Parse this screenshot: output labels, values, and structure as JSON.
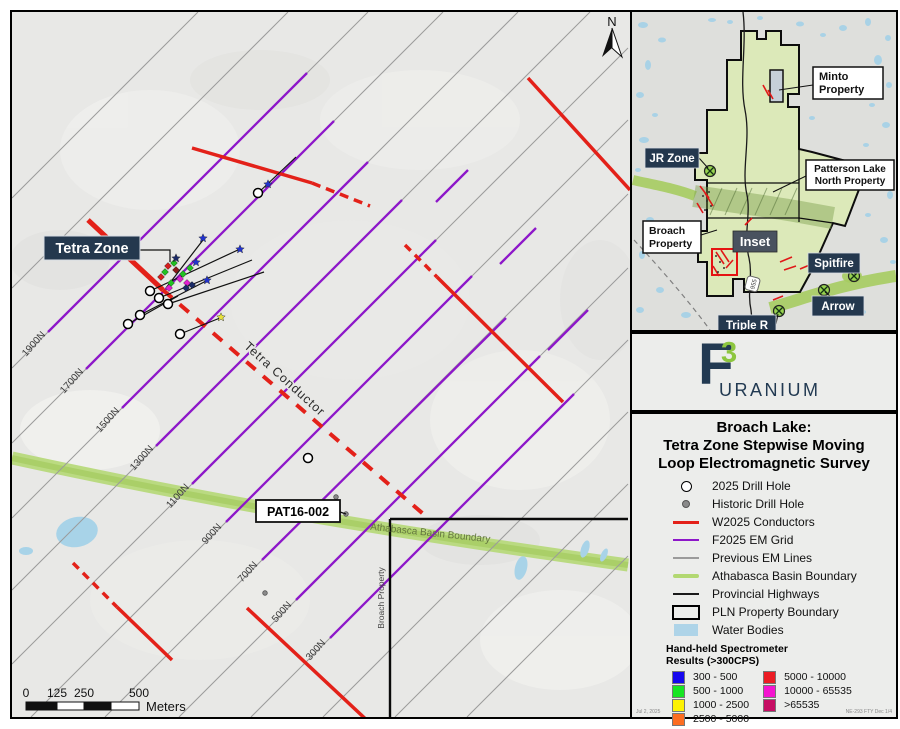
{
  "colors": {
    "conductor_red": "#e32119",
    "em_grid_purple": "#8d17c9",
    "previous_em_gray": "#9b9b9b",
    "basin_green": "#b2d871",
    "water_blue": "#aed4e8",
    "label_navy": "#24384e",
    "logo_navy": "#223a52",
    "logo_green": "#8dc63f"
  },
  "main_map": {
    "tetra_zone_label": "Tetra Zone",
    "tetra_conductor_label": "Tetra Conductor",
    "pat16_label": "PAT16-002",
    "athabasca_label": "Athabasca Basin Boundary",
    "broach_property_label": "Broach Property",
    "north_label": "N",
    "line_labels": [
      "1900N",
      "1700N",
      "1500N",
      "1300N",
      "1100N",
      "900N",
      "700N",
      "500N",
      "300N"
    ],
    "scale_ticks": [
      "0",
      "125",
      "250",
      "500"
    ],
    "scale_unit": "Meters"
  },
  "inset": {
    "minto_line1": "Minto",
    "minto_line2": "Property",
    "jr_zone": "JR Zone",
    "pln_line1": "Patterson Lake",
    "pln_line2": "North Property",
    "broach_line1": "Broach",
    "broach_line2": "Property",
    "inset_label": "Inset",
    "spitfire": "Spitfire",
    "arrow": "Arrow",
    "triple_r": "Triple R",
    "highway_955": "955"
  },
  "logo": {
    "f": "F",
    "three": "3",
    "name": "URANIUM"
  },
  "legend": {
    "title_line1": "Broach Lake:",
    "title_line2": "Tetra Zone Stepwise Moving",
    "title_line3": "Loop Electromagnetic Survey",
    "items": [
      {
        "label": "2025 Drill Hole",
        "swatch": "open-circle"
      },
      {
        "label": "Historic Drill Hole",
        "swatch": "gray-dot"
      },
      {
        "label": "W2025 Conductors",
        "swatch": "red-line",
        "color": "#e32119"
      },
      {
        "label": "F2025 EM Grid",
        "swatch": "purple-line",
        "color": "#8d17c9"
      },
      {
        "label": "Previous EM Lines",
        "swatch": "gray-line",
        "color": "#9b9b9b"
      },
      {
        "label": "Athabasca Basin Boundary",
        "swatch": "green-line",
        "color": "#b2d871"
      },
      {
        "label": "Provincial Highways",
        "swatch": "black-line",
        "color": "#1a1a1a"
      },
      {
        "label": "PLN Property Boundary",
        "swatch": "black-rect"
      },
      {
        "label": "Water Bodies",
        "swatch": "blue-rect",
        "color": "#aed4e8"
      }
    ],
    "spectrometer": {
      "title_line1": "Hand-held Spectrometer",
      "title_line2": "Results (>300CPS)",
      "classes": [
        {
          "range": "300 - 500",
          "color": "#1607ee"
        },
        {
          "range": "500 - 1000",
          "color": "#17e523"
        },
        {
          "range": "1000 - 2500",
          "color": "#fdf203"
        },
        {
          "range": "2500 - 5000",
          "color": "#fd6d21"
        },
        {
          "range": "5000 - 10000",
          "color": "#ec1c24"
        },
        {
          "range": "10000 - 65535",
          "color": "#f414cf"
        },
        {
          "range": ">65535",
          "color": "#c60d63"
        }
      ]
    },
    "footnote_left": "Jul 2, 2025",
    "footnote_right": "NE-293 FTY Dec 1/4"
  }
}
